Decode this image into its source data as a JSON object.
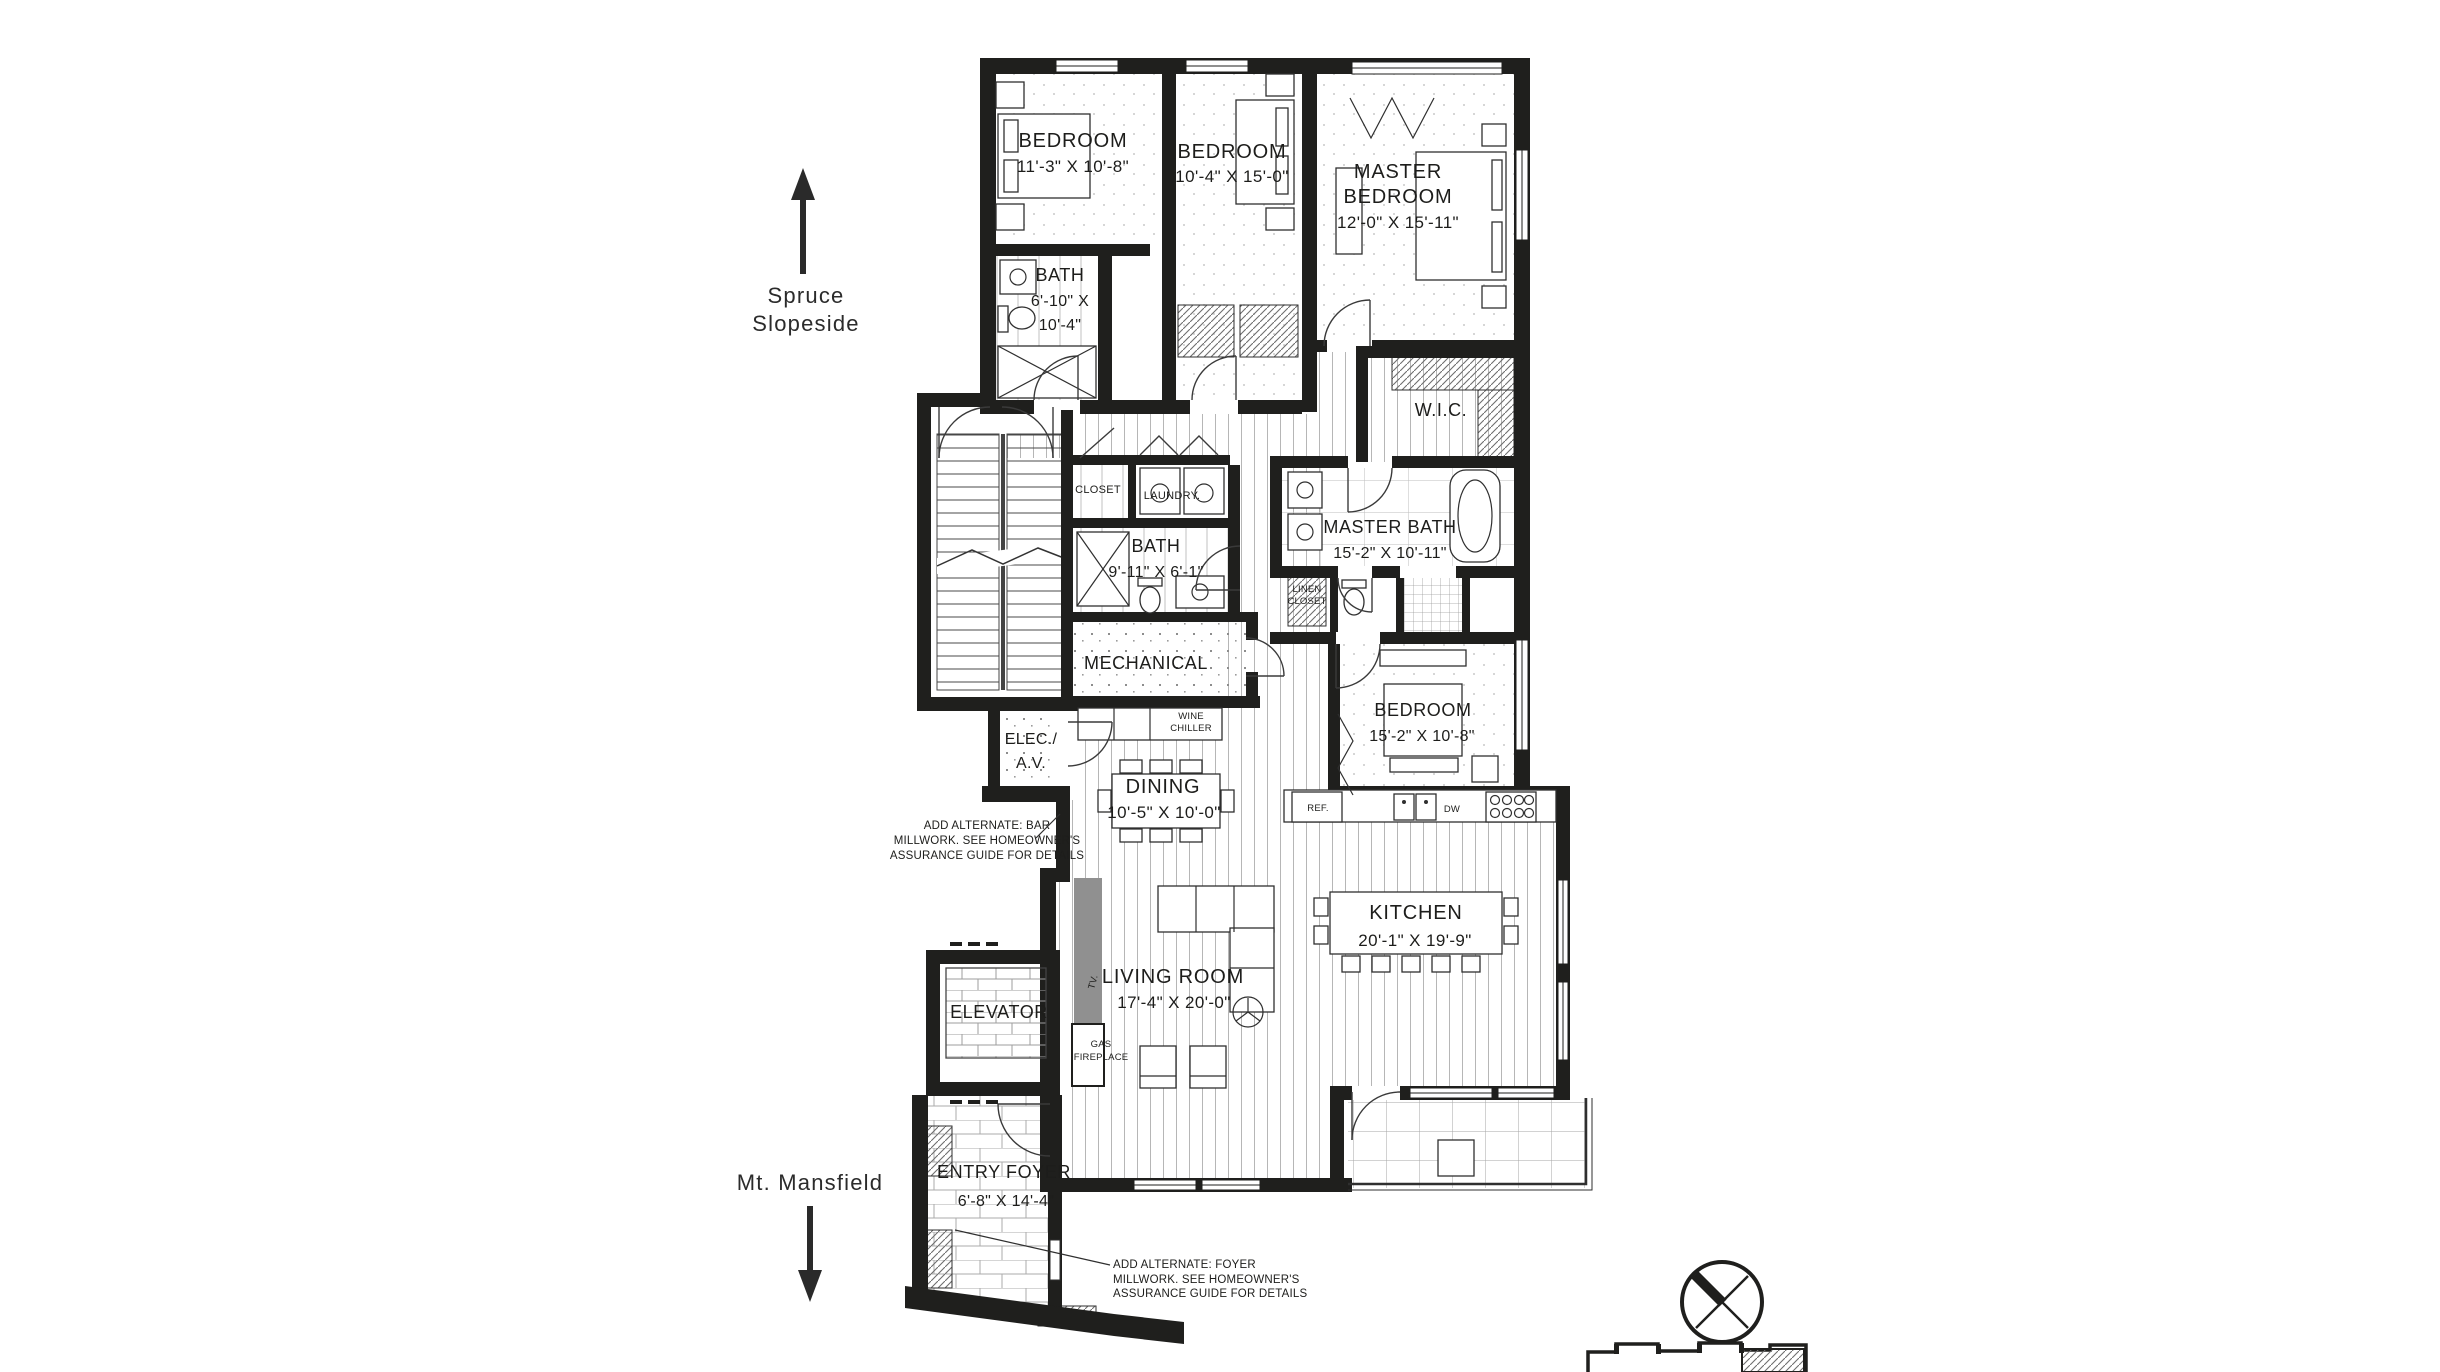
{
  "colors": {
    "wall": "#1f1f1d",
    "line": "#3a3a3a",
    "hatch": "#6e6e6e",
    "text": "#1d1d1b",
    "millwork_gray": "#909090",
    "background": "#ffffff"
  },
  "directions": {
    "up_line1": "Spruce",
    "up_line2": "Slopeside",
    "down_label": "Mt. Mansfield"
  },
  "rooms": {
    "bedroom1": {
      "name": "BEDROOM",
      "dims": "11'-3\" X 10'-8\""
    },
    "bedroom2": {
      "name": "BEDROOM",
      "dims": "10'-4\" X 15'-0\""
    },
    "master_bedroom": {
      "name1": "MASTER",
      "name2": "BEDROOM",
      "dims": "12'-0\" X 15'-11\""
    },
    "bath1": {
      "name": "BATH",
      "dims1": "6'-10\" X",
      "dims2": "10'-4\""
    },
    "wic": {
      "name": "W.I.C."
    },
    "master_bath": {
      "name": "MASTER BATH",
      "dims": "15'-2\" X 10'-11\""
    },
    "linen_closet": {
      "name1": "LINEN",
      "name2": "CLOSET"
    },
    "closet": {
      "name": "CLOSET"
    },
    "laundry": {
      "name": "LAUNDRY."
    },
    "bath2": {
      "name": "BATH",
      "dims": "9'-11\" X 6'-1\""
    },
    "mechanical": {
      "name": "MECHANICAL"
    },
    "elec_av": {
      "name1": "ELEC./",
      "name2": "A.V."
    },
    "dining": {
      "name": "DINING",
      "dims": "10'-5\" X 10'-0\""
    },
    "bedroom4": {
      "name": "BEDROOM",
      "dims": "15'-2\" X 10'-8\""
    },
    "kitchen": {
      "name": "KITCHEN",
      "dims": "20'-1\" X 19'-9\""
    },
    "living_room": {
      "name": "LIVING ROOM",
      "dims": "17'-4\" X 20'-0\""
    },
    "elevator": {
      "name": "ELEVATOR"
    },
    "entry_foyer": {
      "name": "ENTRY FOYER",
      "dims": "6'-8\" X 14'-4\""
    }
  },
  "fixtures": {
    "wine1": "WINE",
    "wine2": "CHILLER",
    "ref": "REF.",
    "dw": "DW",
    "tv": "TV.",
    "gas1": "GAS",
    "gas2": "FIREPLACE"
  },
  "notes": {
    "bar1": "ADD ALTERNATE: BAR",
    "bar2": "MILLWORK. SEE HOMEOWNER'S",
    "bar3": "ASSURANCE GUIDE FOR DETAILS",
    "foyer1": "ADD ALTERNATE: FOYER",
    "foyer2": "MILLWORK. SEE HOMEOWNER'S",
    "foyer3": "ASSURANCE GUIDE FOR DETAILS"
  },
  "icons": {
    "compass": "compass-rose-icon",
    "key_plan": "building-key-plan-icon",
    "arrow_up": "arrow-up-icon",
    "arrow_down": "arrow-down-icon"
  }
}
